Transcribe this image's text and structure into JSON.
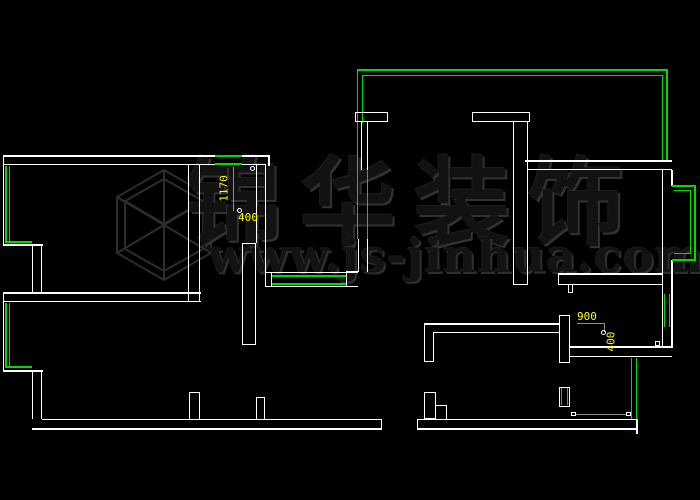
{
  "canvas": {
    "description": "CAD floor plan drawing canvas",
    "background": "#000000"
  },
  "watermark": {
    "logo": "cube-wireframe",
    "brand_text": "锦华装饰",
    "website": "www.js-jinhua.com"
  },
  "dimensions": {
    "left_vertical": {
      "value": "1170"
    },
    "left_horizontal": {
      "value": "400"
    },
    "right_horizontal": {
      "value": "900"
    },
    "right_vertical": {
      "value": "400"
    }
  },
  "colors": {
    "wall": "#ffffff",
    "window_green": "#00da00",
    "dimension_yellow": "#ffff00",
    "dim_line_gray": "#8f8f8f",
    "watermark_gray": "#2e2e2e"
  }
}
